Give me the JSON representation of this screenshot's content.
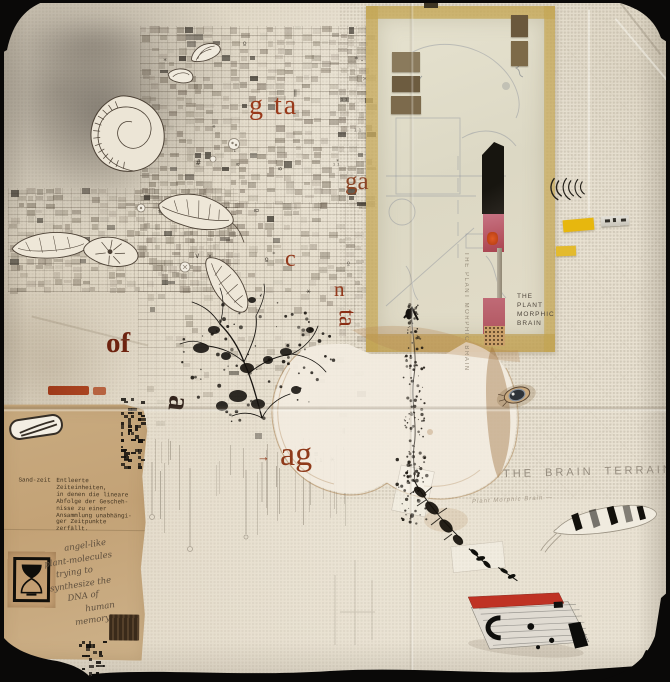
{
  "meta": {
    "alt": "Mixed-media collage artwork on folded cream paper, photographed on a black background"
  },
  "letters": {
    "gta": "g ta",
    "ga": "ga",
    "c": "c",
    "n": "n",
    "ta": "ta",
    "of": "of",
    "a": "a",
    "ag": "ag",
    "arrow": "→"
  },
  "inscriptions": {
    "plant_morphic": {
      "l1": "THE",
      "l2": "PLANT",
      "l3": "MORPHIC",
      "l4": "BRAIN"
    },
    "strip_vertical": "THE PLANT MORPHIC BRAIN",
    "brain_terrain": "THE BRAIN TERRAIN",
    "faint_note": "Plant Morphic Brain —"
  },
  "typed_note": {
    "label": "Sand-zeit",
    "lines": [
      "Entleerte Zeiteinheiten,",
      "in denen die lineare",
      "Abfolge der Gescheh-",
      "nisse zu einer",
      "Ansammlung unabhängi-",
      "ger Zeitpunkte",
      "zerfällt."
    ]
  },
  "handwritten_note": {
    "lines": [
      "angel-like",
      "plant-molecules",
      "trying to",
      "synthesize the",
      "DNA of",
      "human",
      "memory"
    ]
  },
  "decorative_glyphs": [
    "x",
    "*",
    "¹¹",
    "‖",
    "º",
    "v",
    "≡",
    "·",
    "#",
    "₁"
  ],
  "palette": {
    "backdrop": "#0a0908",
    "paper": "#e6decd",
    "tan_paper": "#c7a87e",
    "overlay_yellow": "#d9c070",
    "accent_red": "#9c3a1c",
    "stain_brown": "#a87e4c",
    "ink": "#1a1713",
    "yellow_chip": "#e7b70e",
    "pink_strip": "#c4707c",
    "knife_red": "#bf3224"
  }
}
